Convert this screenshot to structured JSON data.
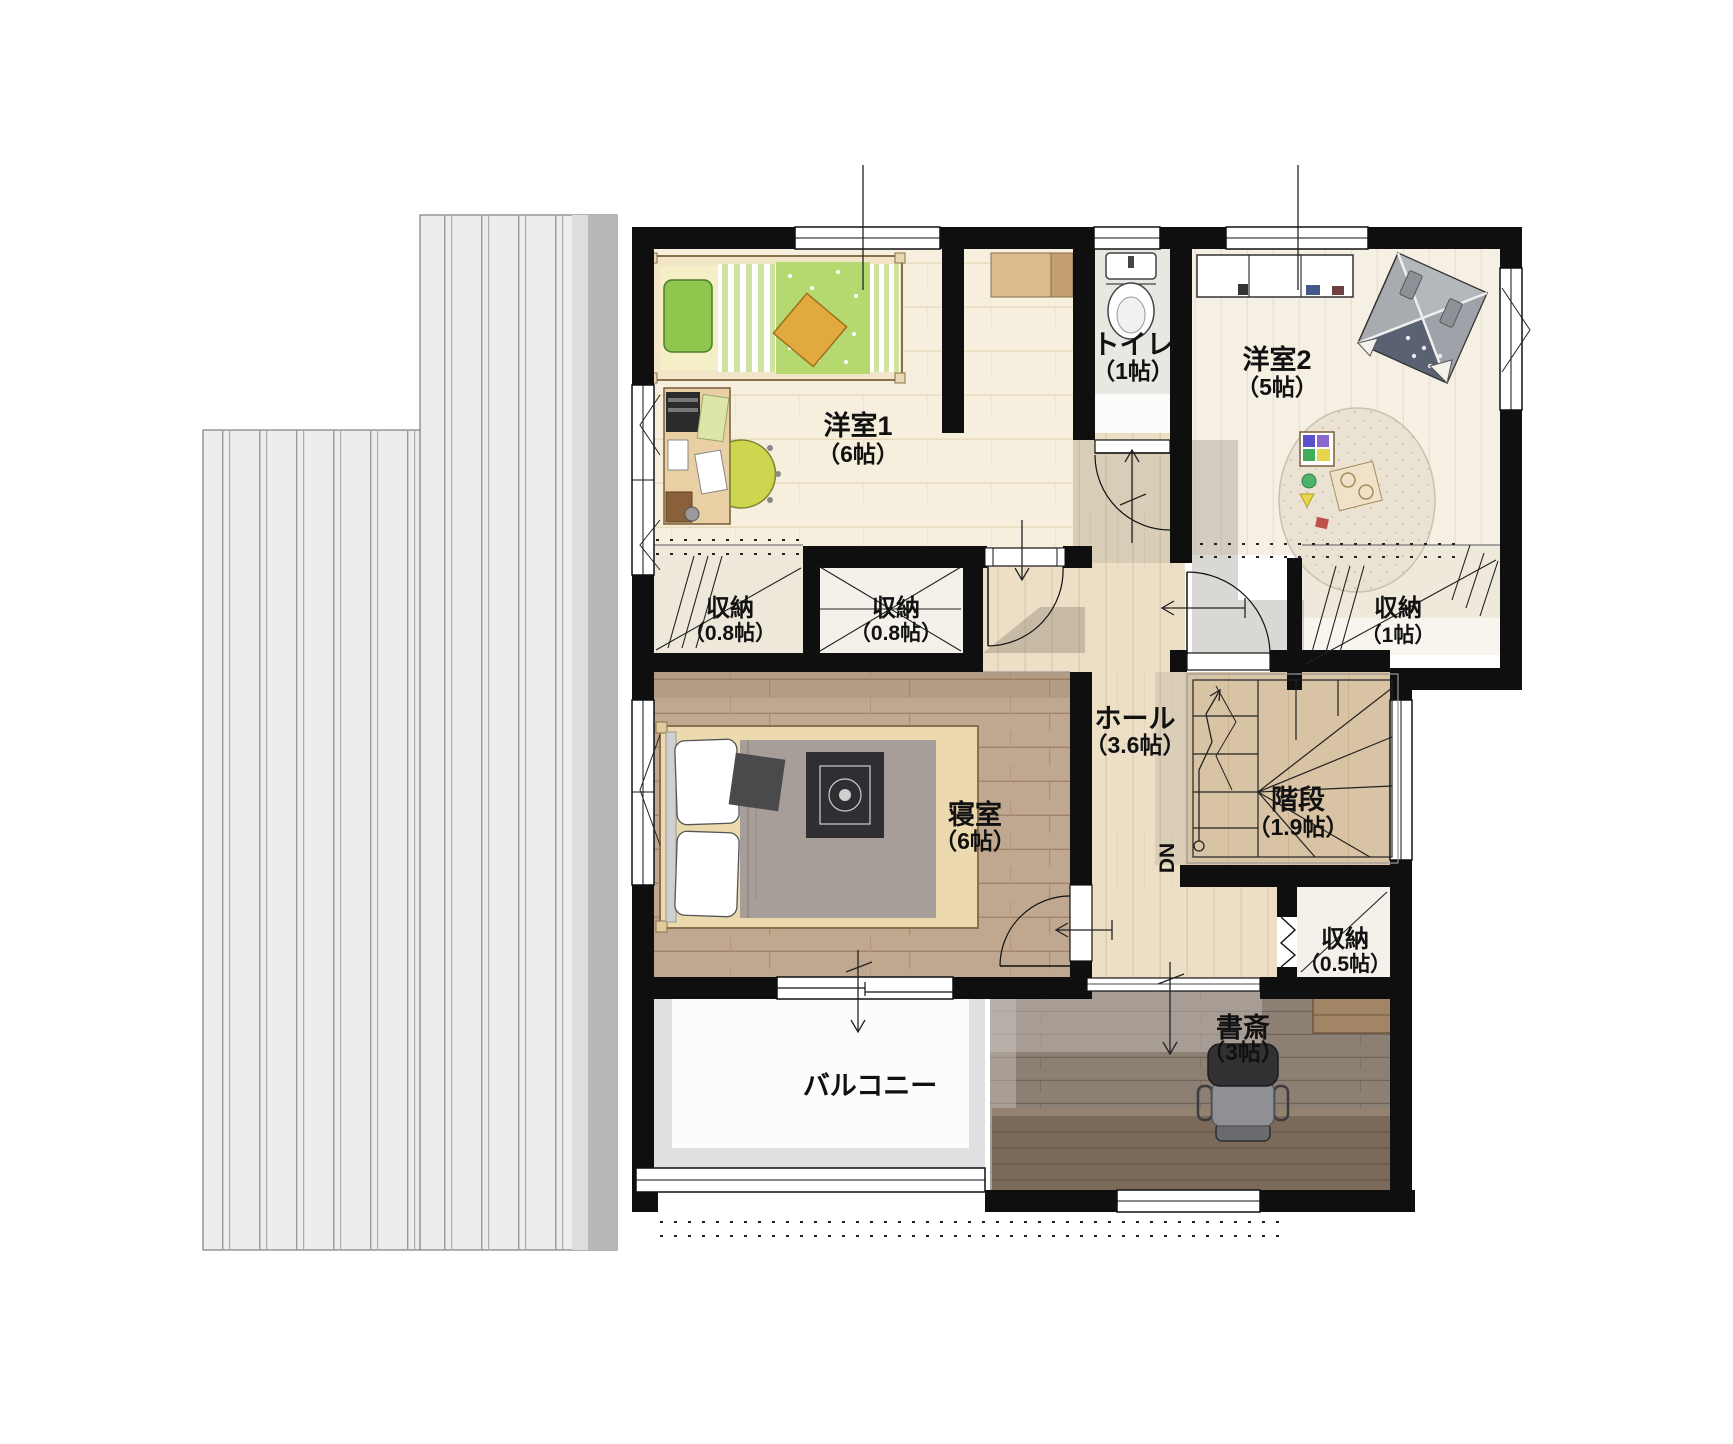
{
  "plan": {
    "type": "floorplan-2f",
    "rooms": {
      "yoshitsu1": {
        "name": "洋室1",
        "size": "（6帖）"
      },
      "toilet": {
        "name": "トイレ",
        "size": "（1帖）"
      },
      "yoshitsu2": {
        "name": "洋室2",
        "size": "（5帖）"
      },
      "closet_a": {
        "name": "収納",
        "size": "（0.8帖）"
      },
      "closet_b": {
        "name": "収納",
        "size": "（0.8帖）"
      },
      "closet_c": {
        "name": "収納",
        "size": "（1帖）"
      },
      "hall": {
        "name": "ホール",
        "size": "（3.6帖）"
      },
      "stairs": {
        "name": "階段",
        "size": "（1.9帖）",
        "direction": "DN"
      },
      "bedroom": {
        "name": "寝室",
        "size": "（6帖）"
      },
      "closet_d": {
        "name": "収納",
        "size": "（0.5帖）"
      },
      "study": {
        "name": "書斎",
        "size": "（3帖）"
      },
      "balcony": {
        "name": "バルコニー"
      }
    },
    "colors": {
      "wall": "#0f0f0f",
      "roof": "#ededed",
      "roof_shadow": "#b8b8b8",
      "floor_tile": "#f7efdd",
      "floor_hall": "#ecdfc6",
      "floor_bedroom": "#bfa88f",
      "floor_study": "#8c7f73",
      "floor_yoshitsu2": "#f5f0e3",
      "accent_pillow_green": "#8fc64e",
      "accent_quilt_green": "#b5d96e",
      "accent_cushion_orange": "#e2a93f",
      "chair_green": "#cdd64e",
      "tent_gray": "#9fa3a9",
      "blanket_gray": "#a79d99"
    }
  }
}
